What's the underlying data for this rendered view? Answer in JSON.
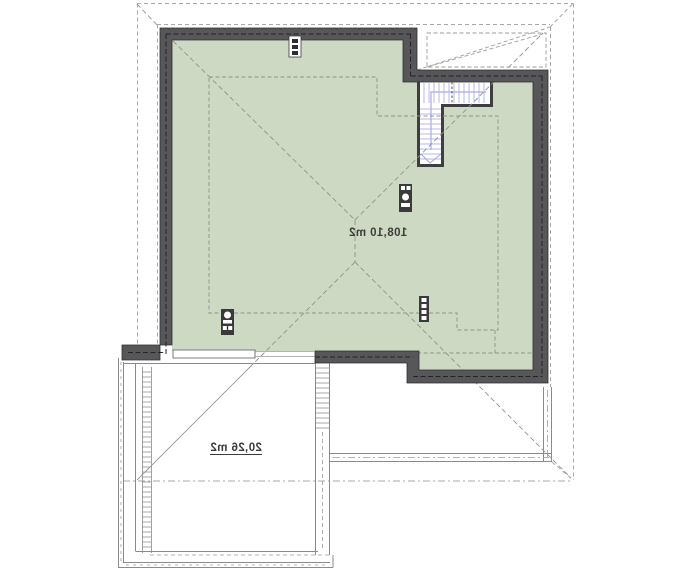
{
  "drawing": {
    "title": "attic-roof-plan-mirrored",
    "areas": [
      {
        "id": "attic",
        "label": "108,10 m2"
      },
      {
        "id": "garage-roof",
        "label": "20,26 m2"
      }
    ],
    "colors": {
      "floor_fill": "#cdd9c3",
      "wall": "#57575a",
      "stair_tread": "#b7b7ec",
      "roof_dash": "#8f948b",
      "boundary_dash": "#a8a8a8",
      "outline": "#8a8a8a"
    }
  }
}
